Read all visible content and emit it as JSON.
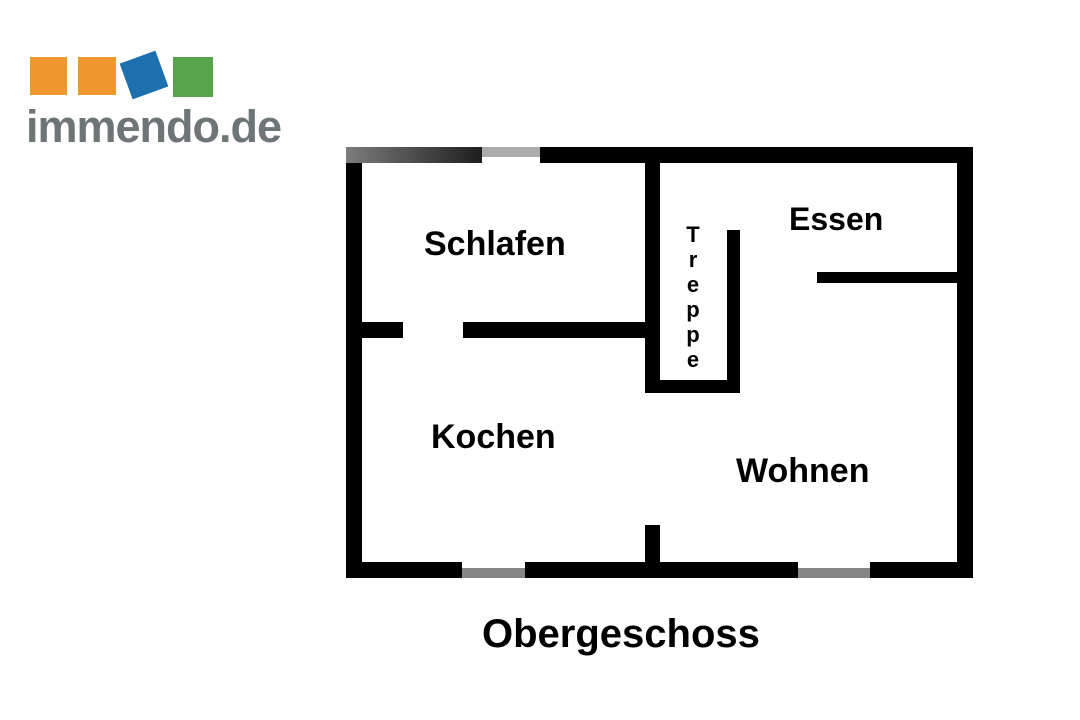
{
  "logo": {
    "text": "immendo.de",
    "colors": {
      "orange": "#F0962F",
      "blue": "#1C70AE",
      "green": "#57A54B",
      "text_gray": "#6D7577"
    }
  },
  "floorplan": {
    "title": "Obergeschoss",
    "rooms": {
      "schlafen": "Schlafen",
      "essen": "Essen",
      "treppe": "Treppe",
      "kochen": "Kochen",
      "wohnen": "Wohnen"
    },
    "colors": {
      "wall": "#000000",
      "top_window_gray": "#ABABAB",
      "bottom_window_gray": "#868686",
      "top_wall_gradient_start": "#7C7C7C",
      "top_wall_gradient_end": "#1E1E1E"
    }
  }
}
